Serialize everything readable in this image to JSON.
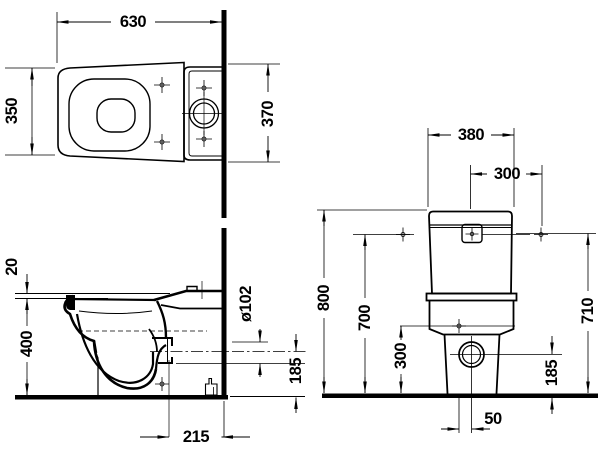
{
  "drawing": {
    "type": "technical-dimension-drawing",
    "subject": "close-coupled toilet (pan and cistern), three orthographic views",
    "colors": {
      "line": "#000000",
      "background": "#ffffff"
    },
    "views": {
      "top": {
        "label": "plan-view",
        "dims": {
          "overall_length": "630",
          "bowl_width": "350",
          "cistern_width": "370"
        }
      },
      "side": {
        "label": "side-section-view",
        "dims": {
          "seat_thickness": "20",
          "bowl_height": "400",
          "outlet_diameter": "ø102",
          "outlet_axis_height": "185",
          "outlet_wall_distance": "215"
        }
      },
      "rear": {
        "label": "rear-view",
        "dims": {
          "cistern_width": "380",
          "supply_offset": "300",
          "overall_height": "800",
          "supply_height_left": "700",
          "supply_height_right": "710",
          "fixing_height": "300",
          "outlet_axis_height": "185",
          "outlet_offset": "50"
        }
      }
    }
  }
}
